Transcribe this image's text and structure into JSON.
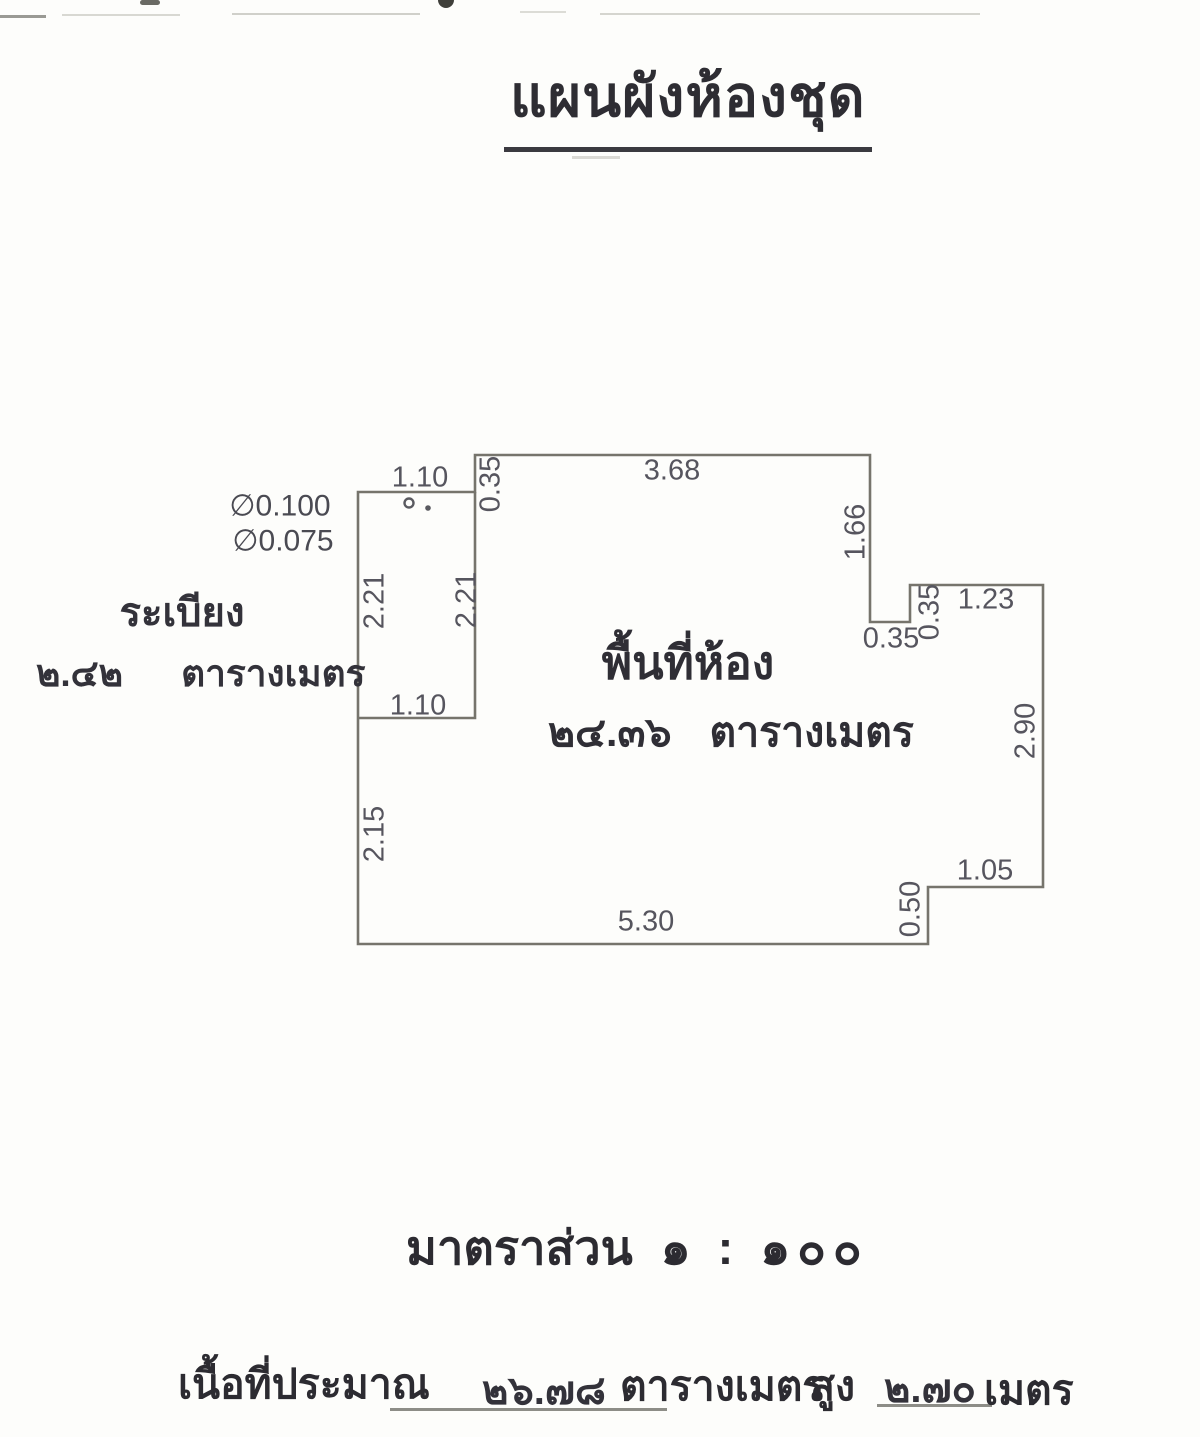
{
  "title": "แผนผังห้องชุด",
  "plan": {
    "balcony": {
      "name": "ระเบียง",
      "area_value": "๒.๔๒",
      "area_unit": "ตารางเมตร",
      "pipe_labels": [
        "∅0.100",
        "∅0.075"
      ]
    },
    "room": {
      "name": "พื้นที่ห้อง",
      "area_value": "๒๔.๓๖",
      "area_unit": "ตารางเมตร"
    },
    "dimensions_m": {
      "balcony_top": "1.10",
      "balcony_bottom": "1.10",
      "balcony_left": "2.21",
      "balcony_right": "2.21",
      "entry_jog": "0.35",
      "top": "3.68",
      "right_upper": "1.66",
      "notch_bottom": "0.35",
      "notch_side": "0.35",
      "notch_top": "1.23",
      "right_lower": "2.90",
      "step_top": "1.05",
      "step_side": "0.50",
      "bottom": "5.30",
      "left_lower": "2.15"
    }
  },
  "scale": {
    "label": "มาตราส่วน",
    "value": "๑ : ๑๐๐"
  },
  "footer": {
    "prefix": "เนื้อที่ประมาณ",
    "area_value": "๒๖.๗๘",
    "area_unit": "ตารางเมตร",
    "height_label": "สูง",
    "height_value": "๒.๗๐",
    "height_unit": "เมตร"
  }
}
